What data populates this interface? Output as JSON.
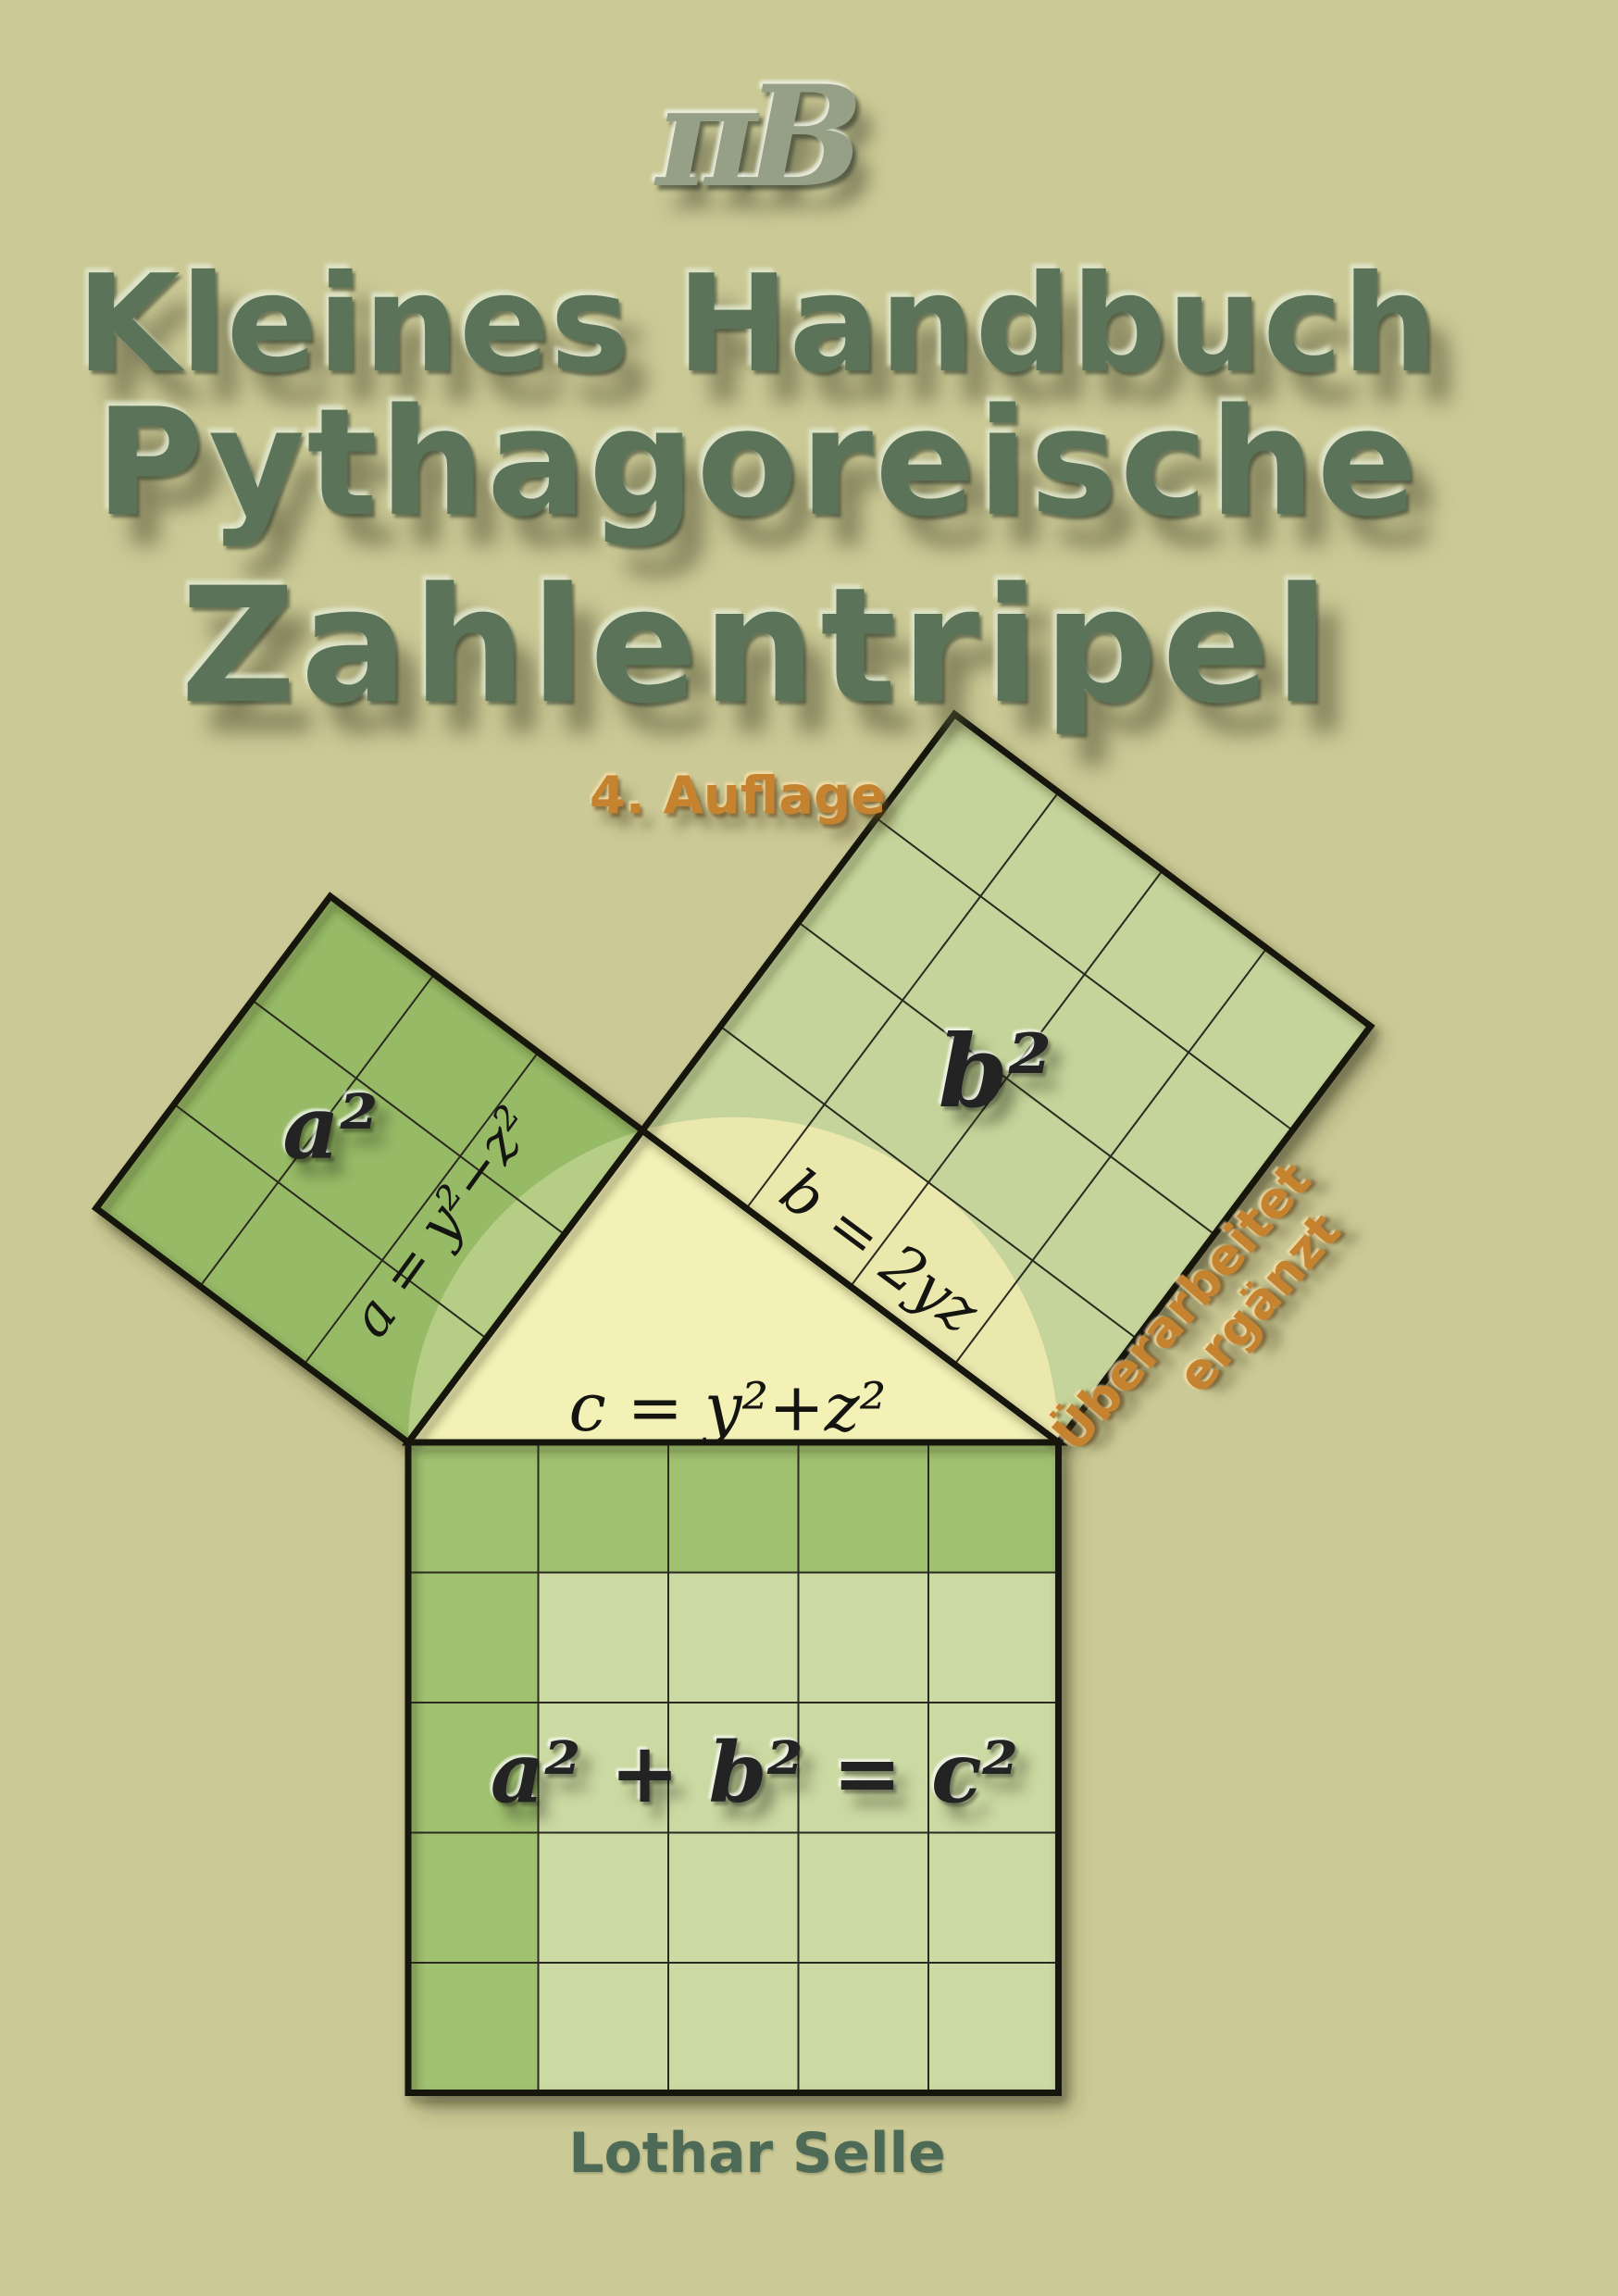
{
  "cover": {
    "logo_text": "πB",
    "title_lines": [
      "Kleines Handbuch",
      "Pythagoreische",
      "Zahlentripel"
    ],
    "edition": "4. Auflage",
    "annotation": {
      "line1": "Überarbeitet",
      "line2": "ergänzt"
    },
    "author": "Lothar Selle"
  },
  "diagram": {
    "square_a_label": "a²",
    "square_b_label": "b²",
    "equation": "a² + b² = c²",
    "side_a_formula": "a = y²−z²",
    "side_b_formula": "b = 2yz",
    "side_c_formula": "c = y²+z²",
    "grid_divisions": {
      "square_a": 3,
      "square_b": 4,
      "square_c": 5
    },
    "triangle_type": "3-4-5 right triangle with Thales semicircle over hypotenuse"
  },
  "colors": {
    "background": "#cbc995",
    "square_a_fill": "#96ba66",
    "square_a_in_circle": "#b5cd85",
    "square_b_fill": "#c4d49a",
    "square_b_in_circle": "#ebe8ae",
    "triangle_fill": "#f4f1b7",
    "square_c_gnomon": "#a0c170",
    "square_c_inner": "#cbd9a2",
    "outline": "#12120c",
    "title_green": "#5b7459",
    "accent_orange": "#c5832f",
    "author_green": "#4c6a55",
    "logo_metal": "#95a086"
  }
}
